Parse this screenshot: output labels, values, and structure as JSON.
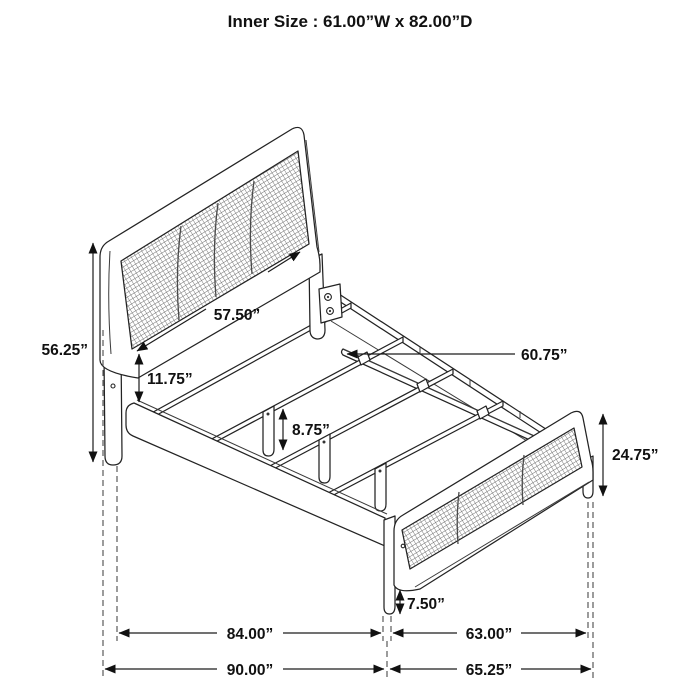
{
  "title": "Inner Size : 61.00”W x 82.00”D",
  "figure": {
    "description": "Isometric line drawing of a cane-panel bed frame with dimension callouts",
    "parts": [
      "headboard",
      "headboard-cane-panel",
      "side-rail",
      "far-side-rail",
      "center-support-rail",
      "slats",
      "slat-support-legs",
      "mounting-bracket",
      "footboard",
      "footboard-cane-panel"
    ]
  },
  "colors": {
    "line": "#232323",
    "background": "#ffffff",
    "dash": "#4a4a4a"
  },
  "dimensions": {
    "headboard_height": "56.25”",
    "headboard_panel_width": "57.50”",
    "panel_to_rail_gap": "11.75”",
    "support_leg_height": "8.75”",
    "center_rail_length": "60.75”",
    "footboard_height": "24.75”",
    "footboard_leg_height": "7.50”",
    "siderail_span": "84.00”",
    "footboard_span": "63.00”",
    "overall_length": "90.00”",
    "overall_width": "65.25”"
  }
}
